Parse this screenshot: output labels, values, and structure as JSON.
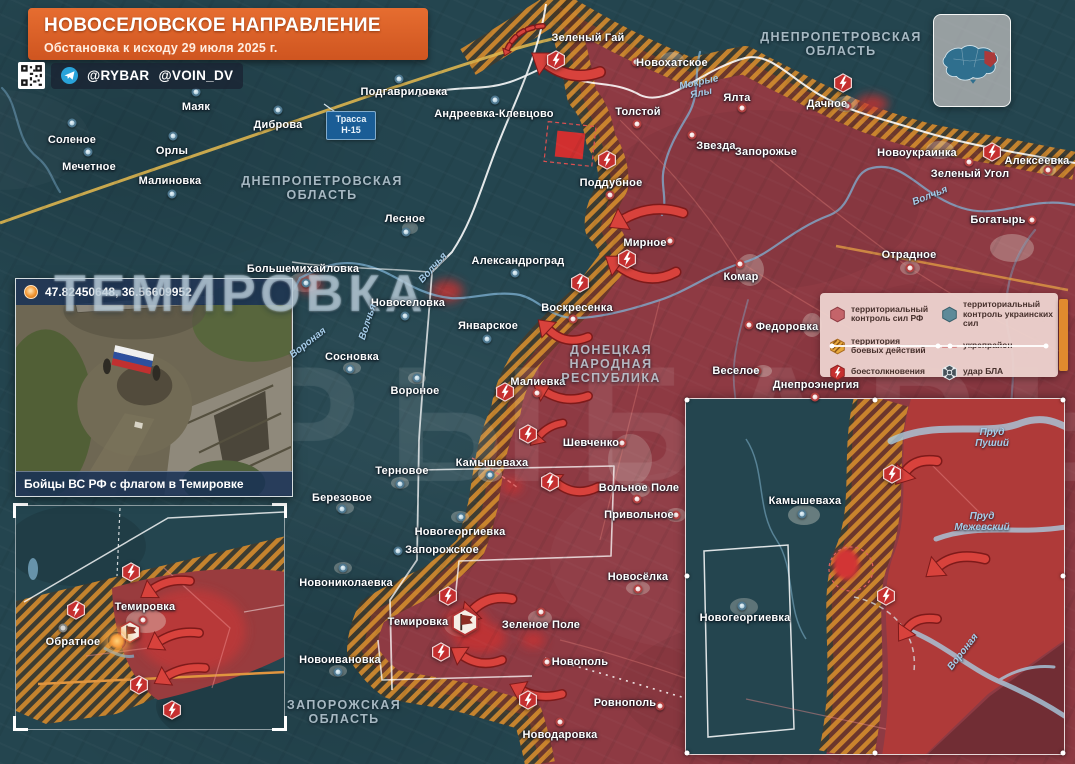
{
  "banner": {
    "title": "НОВОСЕЛОВСКОЕ НАПРАВЛЕНИЕ",
    "subtitle": "Обстановка к исходу 29 июля 2025 г."
  },
  "handles": {
    "telegram1": "@RYBAR",
    "telegram2": "@VOIN_DV"
  },
  "watermarks": {
    "big_location": "ТЕМИРОВКА",
    "brand": "РЫБАРЬ"
  },
  "road_label": {
    "line1": "Трасса",
    "line2": "Н-15"
  },
  "photo_inset": {
    "coords": "47.82450648, 36.56609952",
    "caption": "Бойцы ВС РФ с флагом в Темировке"
  },
  "legend": {
    "items": [
      {
        "id": "rf-control",
        "icon": "hex-ru",
        "label": "территориальный контроль сил РФ"
      },
      {
        "id": "ua-control",
        "icon": "hex-ua",
        "label": "территориальный контроль украинских сил"
      },
      {
        "id": "combat-zone",
        "icon": "hex-hatch",
        "label": "территория боевых действий"
      },
      {
        "id": "fortified-line",
        "icon": "line",
        "label": "укрепрайон"
      },
      {
        "id": "clashes",
        "icon": "hex-clash",
        "label": "боестолкновения"
      },
      {
        "id": "uav-strike",
        "icon": "drone",
        "label": "удар БЛА"
      }
    ]
  },
  "colors": {
    "accent": "#d95f27",
    "rf_zone": "#8e3a43",
    "ua_zone": "#24454f",
    "combat_hatch": "#d28a2e",
    "arrow": "#d8423c",
    "water": "#7fb2d4"
  },
  "map": {
    "regions": [
      {
        "text": "ДНЕПРОПЕТРОВСКАЯ\nОБЛАСТЬ",
        "x": 841,
        "y": 44
      },
      {
        "text": "ДНЕПРОПЕТРОВСКАЯ\nОБЛАСТЬ",
        "x": 322,
        "y": 188
      },
      {
        "text": "ДОНЕЦКАЯ\nНАРОДНАЯ\nРЕСПУБЛИКА",
        "x": 611,
        "y": 364
      },
      {
        "text": "ЗАПОРОЖСКАЯ\nОБЛАСТЬ",
        "x": 344,
        "y": 712
      }
    ],
    "rivers": [
      {
        "text": "Мокрые\nЯлы",
        "x": 700,
        "y": 88,
        "rot": -12
      },
      {
        "text": "Волчья",
        "x": 368,
        "y": 322,
        "rot": -72
      },
      {
        "text": "Волчья",
        "x": 433,
        "y": 268,
        "rot": -48
      },
      {
        "text": "Волчья",
        "x": 930,
        "y": 196,
        "rot": -22
      },
      {
        "text": "Вороная",
        "x": 308,
        "y": 343,
        "rot": -38
      },
      {
        "text": "Пруд\nПуший",
        "x": 992,
        "y": 438,
        "rot": 0
      },
      {
        "text": "Пруд\nМежевский",
        "x": 982,
        "y": 522,
        "rot": 0
      },
      {
        "text": "Вороная",
        "x": 963,
        "y": 652,
        "rot": -52
      }
    ],
    "places": [
      {
        "name": "Соленое",
        "x": 72,
        "y": 140,
        "dx": 72,
        "dy": 123,
        "dc": "ua"
      },
      {
        "name": "Мечетное",
        "x": 89,
        "y": 167,
        "dx": 88,
        "dy": 152,
        "dc": "ua"
      },
      {
        "name": "Маяк",
        "x": 196,
        "y": 107,
        "dx": 196,
        "dy": 92,
        "dc": "ua"
      },
      {
        "name": "Орлы",
        "x": 172,
        "y": 151,
        "dx": 173,
        "dy": 136,
        "dc": "ua"
      },
      {
        "name": "Малиновка",
        "x": 170,
        "y": 181,
        "dx": 172,
        "dy": 194,
        "dc": "ua"
      },
      {
        "name": "Диброва",
        "x": 278,
        "y": 125,
        "dx": 278,
        "dy": 110,
        "dc": "ua"
      },
      {
        "name": "Подгавриловка",
        "x": 404,
        "y": 92,
        "dx": 399,
        "dy": 79,
        "dc": "ua"
      },
      {
        "name": "Андреевка-Клевцово",
        "x": 494,
        "y": 114,
        "dx": 495,
        "dy": 100,
        "dc": "ua"
      },
      {
        "name": "Лесное",
        "x": 405,
        "y": 219,
        "dx": 406,
        "dy": 232,
        "dc": "ua"
      },
      {
        "name": "Александроград",
        "x": 518,
        "y": 261,
        "dx": 515,
        "dy": 273,
        "dc": "ua"
      },
      {
        "name": "Большемихайловка",
        "x": 303,
        "y": 269,
        "dx": 306,
        "dy": 283,
        "dc": "ua"
      },
      {
        "name": "Новоселовка",
        "x": 408,
        "y": 303,
        "dx": 405,
        "dy": 316,
        "dc": "ua"
      },
      {
        "name": "Январское",
        "x": 488,
        "y": 326,
        "dx": 487,
        "dy": 339,
        "dc": "ua"
      },
      {
        "name": "Сосновка",
        "x": 352,
        "y": 357,
        "dx": 350,
        "dy": 369,
        "dc": "ua"
      },
      {
        "name": "Вороное",
        "x": 415,
        "y": 391,
        "dx": 417,
        "dy": 378,
        "dc": "ua"
      },
      {
        "name": "Терновое",
        "x": 402,
        "y": 471,
        "dx": 400,
        "dy": 484,
        "dc": "ua"
      },
      {
        "name": "Березовое",
        "x": 342,
        "y": 498,
        "dx": 342,
        "dy": 509,
        "dc": "ua"
      },
      {
        "name": "Новогеоргиевка",
        "x": 460,
        "y": 532,
        "dx": 461,
        "dy": 517,
        "dc": "ua"
      },
      {
        "name": "Запорожское",
        "x": 442,
        "y": 550,
        "dx": 398,
        "dy": 551,
        "dc": "ua"
      },
      {
        "name": "Новониколаевка",
        "x": 346,
        "y": 583,
        "dx": 343,
        "dy": 568,
        "dc": "ua"
      },
      {
        "name": "Новоивановка",
        "x": 340,
        "y": 660,
        "dx": 338,
        "dy": 672,
        "dc": "ua"
      },
      {
        "name": "Камышеваха",
        "x": 492,
        "y": 463,
        "dx": 490,
        "dy": 475,
        "dc": "ua"
      },
      {
        "name": "Зеленый Гай",
        "x": 588,
        "y": 38
      },
      {
        "name": "Новохатское",
        "x": 672,
        "y": 63,
        "dx": 636,
        "dy": 62,
        "dc": "ru"
      },
      {
        "name": "Ялта",
        "x": 737,
        "y": 98,
        "dx": 742,
        "dy": 108,
        "dc": "ru"
      },
      {
        "name": "Толстой",
        "x": 638,
        "y": 112,
        "dx": 637,
        "dy": 124,
        "dc": "ru"
      },
      {
        "name": "Звезда",
        "x": 716,
        "y": 146,
        "dx": 692,
        "dy": 135,
        "dc": "ru"
      },
      {
        "name": "Запорожье",
        "x": 766,
        "y": 152
      },
      {
        "name": "Поддубное",
        "x": 611,
        "y": 183,
        "dx": 610,
        "dy": 195,
        "dc": "ru"
      },
      {
        "name": "Мирное",
        "x": 645,
        "y": 243,
        "dx": 670,
        "dy": 241,
        "dc": "ru"
      },
      {
        "name": "Воскресенка",
        "x": 577,
        "y": 308,
        "dx": 573,
        "dy": 319,
        "dc": "ru"
      },
      {
        "name": "Комар",
        "x": 741,
        "y": 277,
        "dx": 740,
        "dy": 264,
        "dc": "ru"
      },
      {
        "name": "Федоровка",
        "x": 787,
        "y": 327,
        "dx": 749,
        "dy": 325,
        "dc": "ru"
      },
      {
        "name": "Веселое",
        "x": 736,
        "y": 371,
        "dx": 757,
        "dy": 371,
        "dc": "ru"
      },
      {
        "name": "Днепроэнергия",
        "x": 816,
        "y": 385,
        "dx": 815,
        "dy": 397,
        "dc": "ru"
      },
      {
        "name": "Отрадное",
        "x": 909,
        "y": 255,
        "dx": 910,
        "dy": 268,
        "dc": "ru"
      },
      {
        "name": "Богатырь",
        "x": 998,
        "y": 220,
        "dx": 1032,
        "dy": 220,
        "dc": "ru"
      },
      {
        "name": "Новоукраинка",
        "x": 917,
        "y": 153,
        "dx": 969,
        "dy": 162,
        "dc": "ru"
      },
      {
        "name": "Зеленый Угол",
        "x": 970,
        "y": 174
      },
      {
        "name": "Алексеевка",
        "x": 1037,
        "y": 161,
        "dx": 1048,
        "dy": 170,
        "dc": "ru"
      },
      {
        "name": "Дачное",
        "x": 827,
        "y": 104,
        "dx": 847,
        "dy": 106,
        "dc": "ru"
      },
      {
        "name": "Малиевка",
        "x": 538,
        "y": 382,
        "dx": 537,
        "dy": 393,
        "dc": "ru"
      },
      {
        "name": "Шевченко",
        "x": 591,
        "y": 443,
        "dx": 622,
        "dy": 443,
        "dc": "ru"
      },
      {
        "name": "Вольное Поле",
        "x": 639,
        "y": 488,
        "dx": 637,
        "dy": 499,
        "dc": "ru"
      },
      {
        "name": "Привольное",
        "x": 639,
        "y": 515,
        "dx": 676,
        "dy": 515,
        "dc": "ru"
      },
      {
        "name": "Новосёлка",
        "x": 638,
        "y": 577,
        "dx": 638,
        "dy": 589,
        "dc": "ru"
      },
      {
        "name": "Зеленое Поле",
        "x": 541,
        "y": 625,
        "dx": 541,
        "dy": 612,
        "dc": "ru"
      },
      {
        "name": "Новополь",
        "x": 580,
        "y": 662,
        "dx": 547,
        "dy": 662,
        "dc": "ru"
      },
      {
        "name": "Ровнополь",
        "x": 625,
        "y": 703,
        "dx": 660,
        "dy": 706,
        "dc": "ru"
      },
      {
        "name": "Новодаровка",
        "x": 560,
        "y": 735,
        "dx": 560,
        "dy": 722,
        "dc": "ru"
      },
      {
        "name": "Темировка",
        "x": 418,
        "y": 622
      },
      {
        "name": "Темировка",
        "x": 145,
        "y": 607,
        "dx": 143,
        "dy": 620,
        "dc": "ru"
      },
      {
        "name": "Обратное",
        "x": 73,
        "y": 642,
        "dx": 63,
        "dy": 628,
        "dc": "gray"
      },
      {
        "name": "Камышеваха",
        "x": 805,
        "y": 501,
        "dx": 802,
        "dy": 514,
        "dc": "ua"
      },
      {
        "name": "Новогеоргиевка",
        "x": 745,
        "y": 618,
        "dx": 742,
        "dy": 606,
        "dc": "ua"
      }
    ],
    "icons": [
      {
        "t": "clash",
        "x": 556,
        "y": 60
      },
      {
        "t": "clash",
        "x": 607,
        "y": 160
      },
      {
        "t": "clash",
        "x": 843,
        "y": 83
      },
      {
        "t": "clash",
        "x": 992,
        "y": 152
      },
      {
        "t": "clash",
        "x": 627,
        "y": 259
      },
      {
        "t": "clash",
        "x": 580,
        "y": 283
      },
      {
        "t": "clash",
        "x": 505,
        "y": 392
      },
      {
        "t": "clash",
        "x": 528,
        "y": 434
      },
      {
        "t": "clash",
        "x": 550,
        "y": 482
      },
      {
        "t": "clash",
        "x": 448,
        "y": 596
      },
      {
        "t": "clash",
        "x": 441,
        "y": 652
      },
      {
        "t": "clash",
        "x": 528,
        "y": 700
      },
      {
        "t": "clash",
        "x": 131,
        "y": 572
      },
      {
        "t": "clash",
        "x": 76,
        "y": 610
      },
      {
        "t": "clash",
        "x": 139,
        "y": 685
      },
      {
        "t": "clash",
        "x": 172,
        "y": 710
      },
      {
        "t": "clash",
        "x": 892,
        "y": 474
      },
      {
        "t": "clash",
        "x": 886,
        "y": 596
      },
      {
        "t": "flag",
        "x": 465,
        "y": 622,
        "s": 30
      },
      {
        "t": "flag",
        "x": 130,
        "y": 632,
        "s": 24
      },
      {
        "t": "glow",
        "x": 117,
        "y": 641
      }
    ],
    "arrows": [
      {
        "t": [
          600,
          72
        ],
        "c": [
          572,
          82
        ],
        "h": [
          547,
          64
        ],
        "w": 9
      },
      {
        "t": [
          543,
          26
        ],
        "c": [
          516,
          28
        ],
        "h": [
          507,
          50
        ],
        "w": 3,
        "dash": true
      },
      {
        "t": [
          683,
          213
        ],
        "c": [
          652,
          203
        ],
        "h": [
          624,
          219
        ],
        "w": 8
      },
      {
        "t": [
          676,
          272
        ],
        "c": [
          648,
          287
        ],
        "h": [
          619,
          266
        ],
        "w": 8
      },
      {
        "t": [
          588,
          337
        ],
        "c": [
          566,
          346
        ],
        "h": [
          549,
          330
        ],
        "w": 7
      },
      {
        "t": [
          588,
          396
        ],
        "c": [
          566,
          404
        ],
        "h": [
          546,
          392
        ],
        "w": 7
      },
      {
        "t": [
          563,
          423
        ],
        "c": [
          549,
          425
        ],
        "h": [
          539,
          436
        ],
        "w": 6
      },
      {
        "t": [
          598,
          487
        ],
        "c": [
          576,
          498
        ],
        "h": [
          557,
          483
        ],
        "w": 7
      },
      {
        "t": [
          512,
          599
        ],
        "c": [
          489,
          594
        ],
        "h": [
          473,
          610
        ],
        "w": 8
      },
      {
        "t": [
          502,
          660
        ],
        "c": [
          481,
          668
        ],
        "h": [
          463,
          656
        ],
        "w": 7
      },
      {
        "t": [
          562,
          694
        ],
        "c": [
          541,
          700
        ],
        "h": [
          523,
          691
        ],
        "w": 7
      },
      {
        "t": [
          190,
          581
        ],
        "c": [
          169,
          578
        ],
        "h": [
          153,
          589
        ],
        "w": 7
      },
      {
        "t": [
          199,
          633
        ],
        "c": [
          178,
          630
        ],
        "h": [
          160,
          641
        ],
        "w": 7
      },
      {
        "t": [
          205,
          668
        ],
        "c": [
          184,
          666
        ],
        "h": [
          167,
          676
        ],
        "w": 7
      },
      {
        "t": [
          937,
          461
        ],
        "c": [
          916,
          458
        ],
        "h": [
          906,
          471
        ],
        "w": 8
      },
      {
        "t": [
          985,
          559
        ],
        "c": [
          956,
          552
        ],
        "h": [
          939,
          566
        ],
        "w": 8
      },
      {
        "t": [
          937,
          619
        ],
        "c": [
          916,
          616
        ],
        "h": [
          907,
          629
        ],
        "w": 7
      }
    ]
  }
}
